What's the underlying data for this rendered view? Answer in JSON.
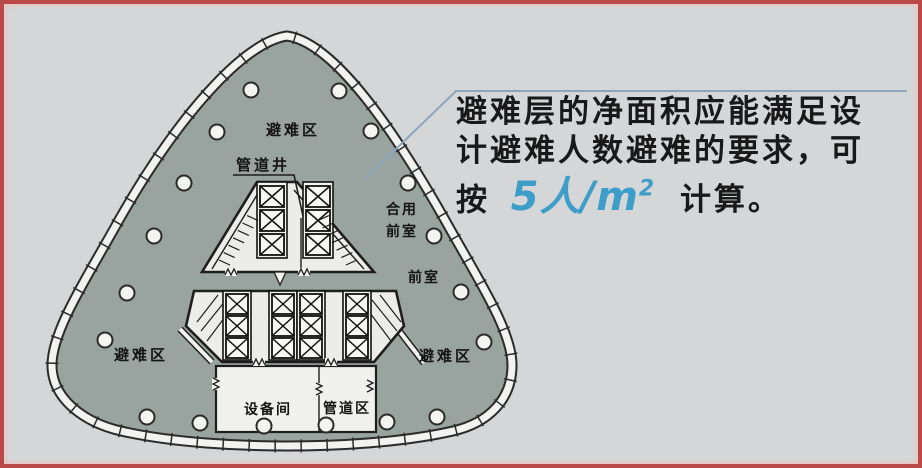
{
  "frame": {
    "border_color": "#b94a48",
    "background_color": "#d4d6d8"
  },
  "plan": {
    "floor_color": "#99a39f",
    "outline_color": "#2b2b2b",
    "labels": {
      "refuge_area_top": "避难区",
      "refuge_area_left": "避难区",
      "refuge_area_right": "避难区",
      "pipe_shaft": "管道井",
      "shared_front_room_line1": "合用",
      "shared_front_room_line2": "前室",
      "front_room": "前室",
      "equipment_room": "设备间",
      "pipe_zone": "管道区"
    },
    "columns": [
      [
        247,
        86
      ],
      [
        335,
        87
      ],
      [
        213,
        128
      ],
      [
        367,
        127
      ],
      [
        180,
        179
      ],
      [
        404,
        179
      ],
      [
        150,
        232
      ],
      [
        430,
        232
      ],
      [
        123,
        289
      ],
      [
        457,
        288
      ],
      [
        101,
        336
      ],
      [
        480,
        338
      ],
      [
        143,
        413
      ],
      [
        196,
        419
      ],
      [
        260,
        422
      ],
      [
        322,
        421
      ],
      [
        383,
        418
      ],
      [
        433,
        413
      ]
    ]
  },
  "annotation": {
    "line1": "避难层的净面积应能满足设",
    "line2": "计避难人数避难的要求，可",
    "line3_prefix": "按",
    "density_value": "5人/m",
    "density_superscript": "2",
    "line3_suffix": "计算。",
    "highlight_color": "#3f9dc9",
    "leader_color": "#8ba6bc"
  }
}
